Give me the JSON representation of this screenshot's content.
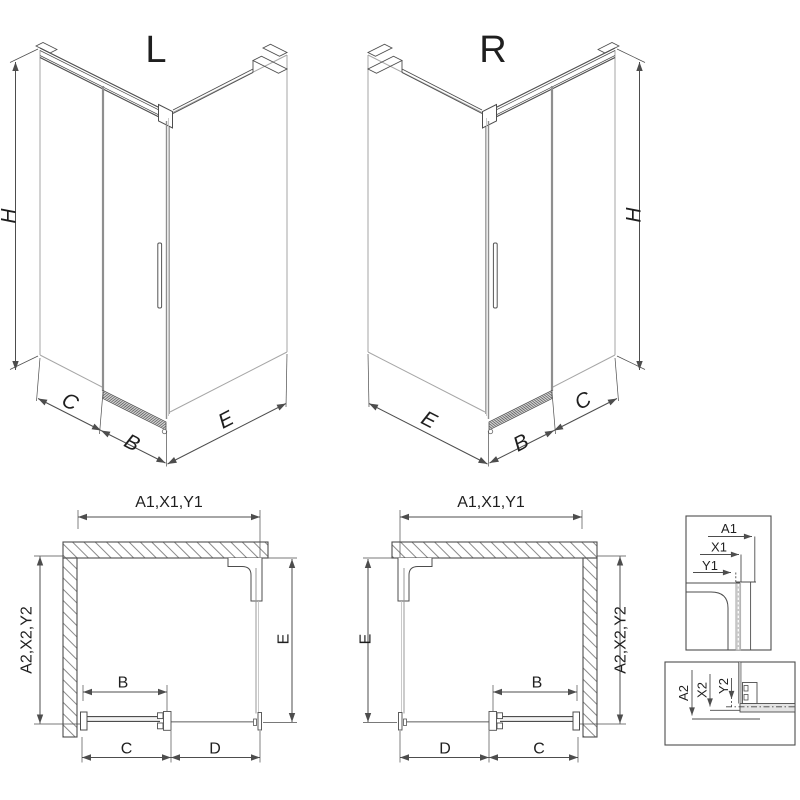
{
  "page": {
    "background": "#ffffff"
  },
  "drawing": {
    "line_color": "#4d4d4d",
    "glass_color": "#a6a6a6",
    "iso_left": {
      "label": "L",
      "height_dim": "H",
      "fixed_dim": "C",
      "door_dim": "B",
      "side_dim": "E"
    },
    "iso_right": {
      "label": "R",
      "height_dim": "H",
      "fixed_dim": "C",
      "door_dim": "B",
      "side_dim": "E"
    },
    "plan_left": {
      "width_dim": "A1,X1,Y1",
      "depth_dim": "A2,X2,Y2",
      "side_dim": "E",
      "door_dim": "B",
      "entry_dim": "C",
      "fixed_dim": "D"
    },
    "plan_right": {
      "width_dim": "A1,X1,Y1",
      "depth_dim": "A2,X2,Y2",
      "side_dim": "E",
      "door_dim": "B",
      "entry_dim": "C",
      "fixed_dim": "D"
    },
    "detail_wall_profile": {
      "labels": [
        "A1",
        "X1",
        "Y1"
      ]
    },
    "detail_bottom_rail": {
      "labels": [
        "A2",
        "X2",
        "Y2"
      ]
    }
  }
}
